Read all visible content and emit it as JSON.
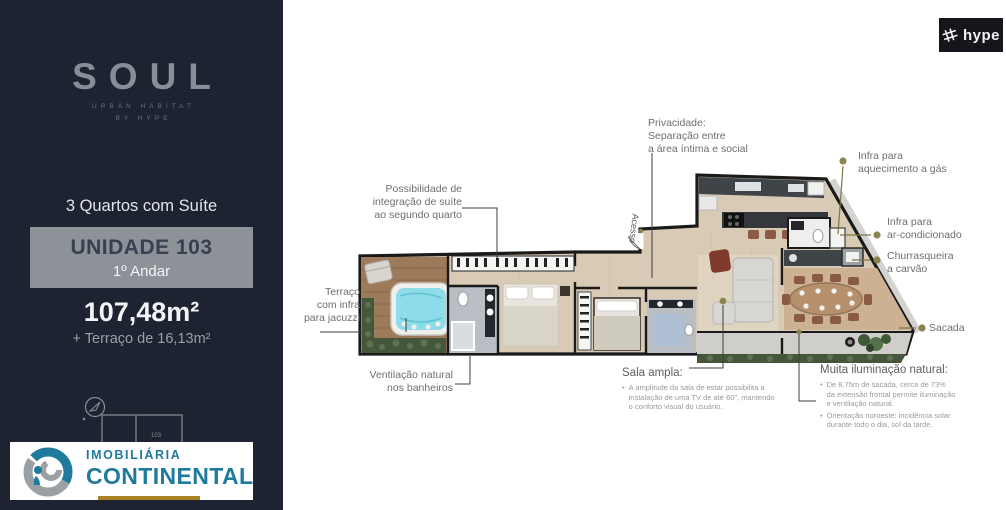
{
  "ui": {
    "bullet": "•"
  },
  "colors": {
    "sidebar_bg": "#1d2330",
    "unit_box_gray": "#8d9198",
    "agency_teal": "#1f7b9e",
    "agency_gold": "#ac8327",
    "callout_olive": "#7a7645",
    "callout_dot": "#8a8550",
    "jacuzzi_water": "#8edce9",
    "hedge_green": "#44563c"
  },
  "sidebar": {
    "brand": {
      "name": "SOUL",
      "tagline1": "URBAN HABITAT",
      "tagline2": "BY HYPE"
    },
    "unit_type": "3 Quartos com Suíte",
    "unit_box": {
      "title": "UNIDADE 103",
      "floor": "1º Andar"
    },
    "area_main": "107,48m²",
    "area_extra": "+ Terraço de 16,13m²",
    "keyplan": {
      "unit_label": "103"
    },
    "agency": {
      "line1": "IMOBILIÁRIA",
      "line2": "CONTINENTAL"
    }
  },
  "header": {
    "logo_text": "hype"
  },
  "floorplan": {
    "access_label": "Acesso",
    "callouts": {
      "privacidade": {
        "lines": [
          "Privacidade:",
          "Separação entre",
          "a área íntima e social"
        ]
      },
      "possibilidade": {
        "lines": [
          "Possibilidade de",
          "integração de suíte",
          "ao segundo quarto"
        ]
      },
      "terraco": {
        "lines": [
          "Terraço",
          "com infra",
          "para jacuzzi"
        ]
      },
      "ventilacao": {
        "lines": [
          "Ventilação natural",
          "nos banheiros"
        ]
      },
      "infra_gas": {
        "lines": [
          "Infra para",
          "aquecimento a gás"
        ]
      },
      "infra_ac": {
        "lines": [
          "Infra para",
          "ar-condicionado"
        ]
      },
      "churrasqueira": {
        "lines": [
          "Churrasqueira",
          "a carvão"
        ]
      },
      "sacada": {
        "label": "Sacada"
      },
      "sala_ampla": {
        "title": "Sala ampla:",
        "bullets": [
          {
            "lines": [
              "A amplitude da sala de estar possibilita a",
              "instalação de uma TV de até 60\", mantendo",
              "o conforto visual do usuário."
            ]
          }
        ]
      },
      "muita_iluminacao": {
        "title": "Muita iluminação natural:",
        "bullets": [
          {
            "lines": [
              "De 8,75m de sacada, cerca de 73%",
              "da extensão frontal permite iluminação",
              "e ventilação natural."
            ]
          },
          {
            "lines": [
              "Orientação noroeste: incidência solar",
              "durante todo o dia, sol da tarde."
            ]
          }
        ]
      }
    }
  }
}
